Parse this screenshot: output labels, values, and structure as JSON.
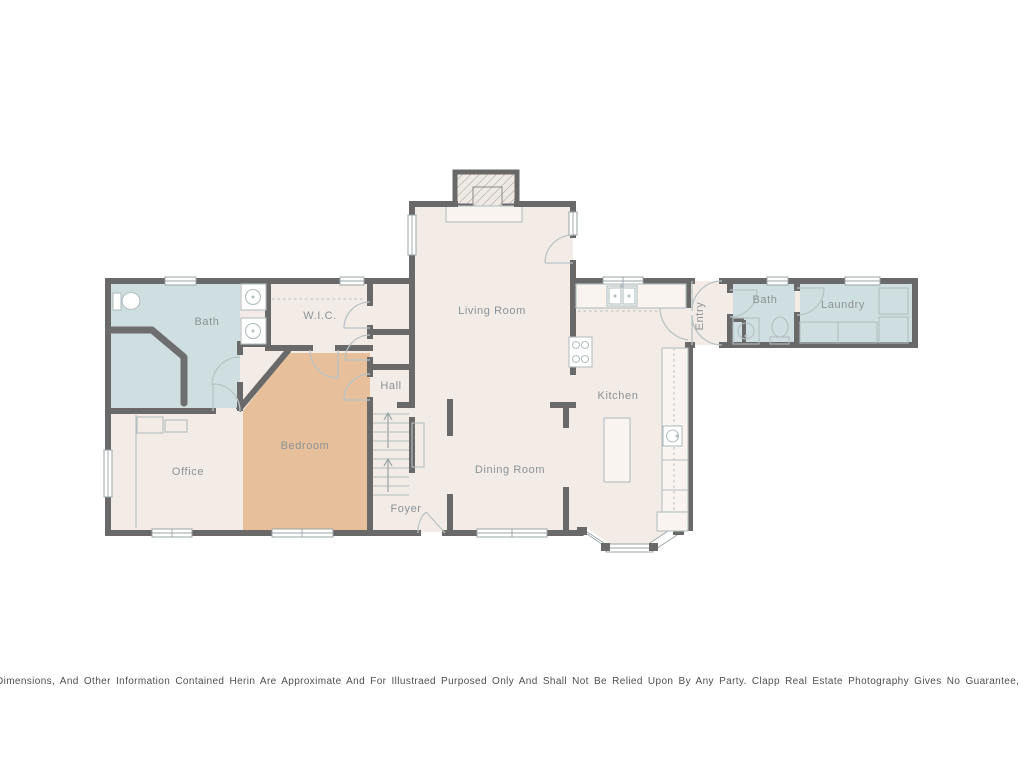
{
  "colors": {
    "room_cream": "#f3ece6",
    "room_blue": "#cfdfe1",
    "room_tan": "#e7c09b",
    "wall": "#696969"
  },
  "rooms": {
    "bath_left": {
      "label": "Bath"
    },
    "wic": {
      "label": "W.I.C."
    },
    "hall": {
      "label": "Hall"
    },
    "living_room": {
      "label": "Living Room"
    },
    "entry": {
      "label": "Entry"
    },
    "bath_right": {
      "label": "Bath"
    },
    "laundry": {
      "label": "Laundry"
    },
    "kitchen": {
      "label": "Kitchen"
    },
    "bedroom": {
      "label": "Bedroom"
    },
    "office": {
      "label": "Office"
    },
    "dining_room": {
      "label": "Dining Room"
    },
    "foyer": {
      "label": "Foyer"
    }
  },
  "disclaimer": {
    "text": "Dimensions, And Other Information Contained Herin Are Approximate And For Illustraed Purposed Only And Shall Not Be Relied Upon By Any Party. Clapp Real Estate Photography Gives No Guarantee, Warranty Or Representation As To The Accuracy Of This"
  }
}
